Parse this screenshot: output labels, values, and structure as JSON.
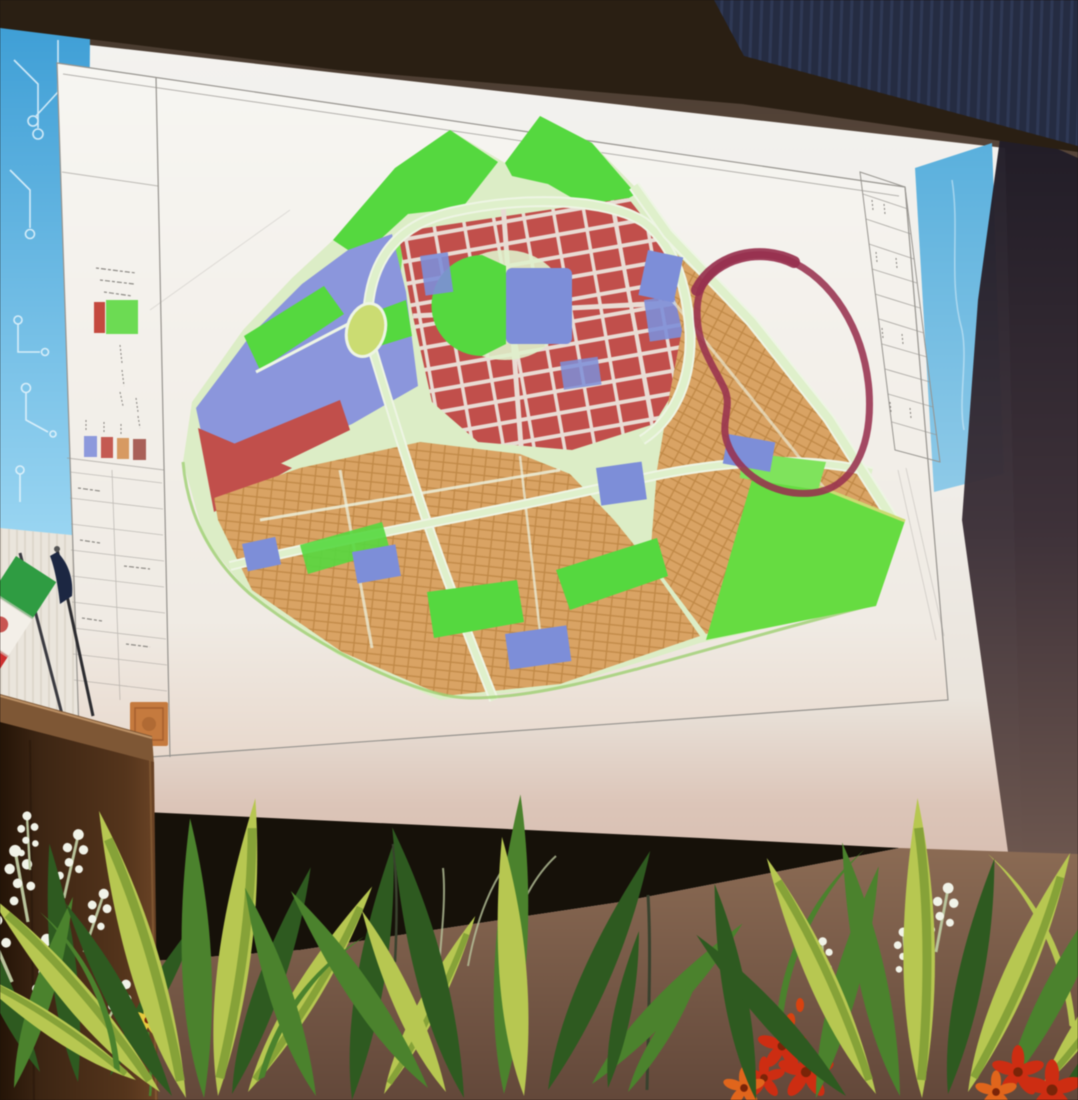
{
  "scene": {
    "type": "photograph",
    "description": "Auditorium stage photographed during a presentation: a large projection screen displays an urban master-plan zoning map sheet with a legend column and title block; a small Iranian desk flag and a wooden podium stand at the left; flower planters fill the foreground in front of the stage.",
    "elements": [
      "ceiling band",
      "navy stage curtain",
      "projection screen",
      "blue slide banners with circuit graphics",
      "zoning map sheet",
      "iran desk flag",
      "second dark flag",
      "wooden podium",
      "white curtain",
      "black stage skirt",
      "wooden stage floor",
      "foreground plants and flowers"
    ]
  },
  "colors": {
    "ceiling": "#2a1f13",
    "curtainNavy": "#252c42",
    "curtainStripe": "#323c5a",
    "shadowTop": "#1f1b26",
    "wallMauve": "#7c6258",
    "screenTop": "#f3f2ef",
    "screenWarm": "#eae4dc",
    "screenPink": "#d8bfb2",
    "bannerBlue1": "#3f9fd6",
    "bannerBlue2": "#9bd6f2",
    "circuit": "#e8f6fd",
    "sheet": "#f7f6f2",
    "sheetBottom": "#e8d8cc",
    "sheetLine": "#96938e",
    "scribble": "#8d8a85",
    "legendRed": "#c4493f",
    "legendGreen": "#6cdb53",
    "swBlue": "#8d99dc",
    "swRed": "#c45a52",
    "swTan": "#d79a62",
    "swMaroon": "#a96058",
    "stampOrange": "#c57a3e",
    "cityBase": "#dcedc6",
    "roadPale": "#dff0cb",
    "roadWhite": "#eef5e4",
    "roadEdge": "#9ed072",
    "parkGreen": "#55d83f",
    "parkBright": "#7fe35c",
    "wedgeGreen": "#66dc41",
    "zoneRed": "#c14f4b",
    "redStreet": "#e9dcd4",
    "zoneTan": "#d9a364",
    "tanLine": "#c08947",
    "zoneBlue": "#7d8ed8",
    "stripsBlue": "#8b96dc",
    "roundabout": "#cbdc72",
    "annotation": "#97314e",
    "flagGreen": "#2f9c42",
    "flagWhite": "#f3efe8",
    "flagRed": "#ce2f2f",
    "flagEmblem": "#bf3a36",
    "poleDark": "#2c2c30",
    "flag2Navy": "#1c2742",
    "curtainWhite": "#eae5dc",
    "curtainLine": "#d6cec1",
    "podiumRail": "#7e5735",
    "podiumEdge": "#c99e70",
    "skirtBlack": "#161109",
    "floorLight": "#8b6b54",
    "floorDark": "#63483a",
    "leafDark": "#2e5a20",
    "leafMid": "#4b822d",
    "leafStripe": "#b7c751",
    "leafStripeCore": "#86a238",
    "stemPale": "#b9c49c",
    "flowerWhite": "#f1f3e8",
    "flowerRed": "#cd2d12",
    "flowerOrange": "#e0651c",
    "flowerYellow": "#e7ca3e"
  },
  "projection": {
    "slide": {
      "left_banner": "light blue banner with white circuit-board line art",
      "right_banner": "light blue banner",
      "content": "white engineering drawing sheet"
    }
  },
  "map": {
    "kind": "urban master plan / land-use zoning drawing",
    "text_legible": false,
    "districts": [
      {
        "name": "parks and green space",
        "color_ref": "parkGreen"
      },
      {
        "name": "residential blocks (red) with street grid",
        "color_ref": "zoneRed"
      },
      {
        "name": "parcel blocks (tan) with fine plot grid",
        "color_ref": "zoneTan"
      },
      {
        "name": "mixed-use patches (blue)",
        "color_ref": "zoneBlue"
      },
      {
        "name": "left wing strip district (periwinkle)",
        "color_ref": "stripsBlue"
      }
    ],
    "features": [
      {
        "name": "oval roundabout",
        "color_ref": "roundabout"
      },
      {
        "name": "stadium park半 circle with blue field",
        "color_ref": "parkGreen"
      },
      {
        "name": "freehand maroon loop annotation",
        "color_ref": "annotation"
      },
      {
        "name": "diagonal boundary highway",
        "color_ref": "roadPale"
      },
      {
        "name": "green boundary wedge",
        "color_ref": "wedgeGreen"
      }
    ],
    "legend": {
      "text_legible": false,
      "top_swatches": [
        {
          "color_ref": "legendRed"
        },
        {
          "color_ref": "legendGreen"
        }
      ],
      "row_swatches": [
        {
          "color_ref": "swBlue"
        },
        {
          "color_ref": "swRed"
        },
        {
          "color_ref": "swTan"
        },
        {
          "color_ref": "swMaroon"
        }
      ],
      "stamp": {
        "color_ref": "stampOrange"
      }
    },
    "title_block": {
      "rows": 10,
      "text_legible": false
    }
  },
  "flags": {
    "iran_flag": {
      "stripes": [
        {
          "color_ref": "flagGreen"
        },
        {
          "color_ref": "flagWhite"
        },
        {
          "color_ref": "flagRed"
        }
      ],
      "emblem": {
        "color_ref": "flagEmblem"
      }
    },
    "second_flag": {
      "color_ref": "flag2Navy"
    }
  },
  "furniture": {
    "podium": "dark wooden podium, left foreground",
    "planters": "row of plants with white, yellow, red and orange flowers"
  }
}
